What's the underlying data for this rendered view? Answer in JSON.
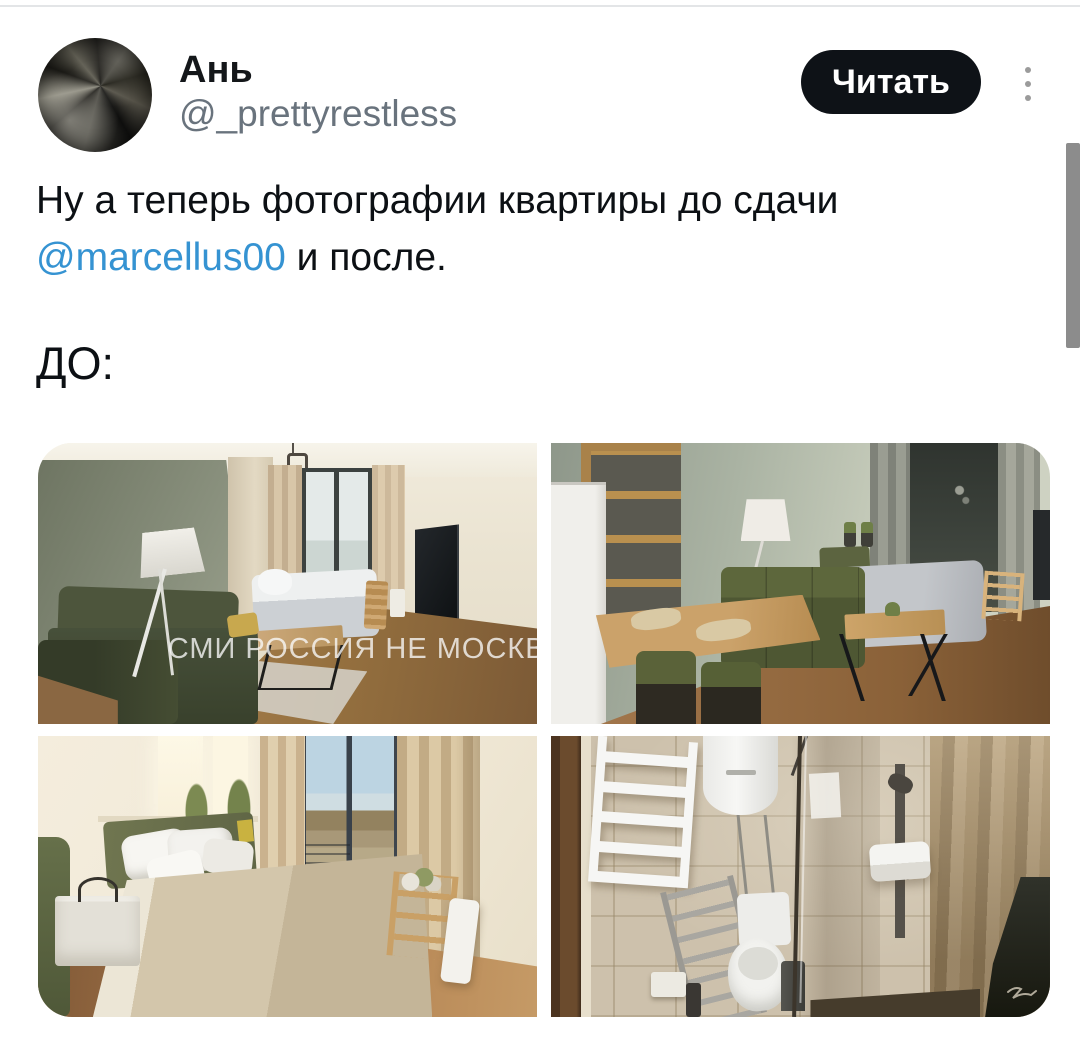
{
  "header": {
    "name": "Ань",
    "handle": "@_prettyrestless",
    "follow_label": "Читать"
  },
  "tweet": {
    "text_before": "Ну а теперь фотографии квартиры до сдачи ",
    "mention": "@marcellus00",
    "text_after": " и после.",
    "section_label": "ДО:"
  },
  "photos": {
    "watermark": "СМИ РОССИЯ НЕ МОСКВА",
    "items": [
      {
        "description": "Living room with green wall, olive sofa, floor lamp, coffee table, wall TV and bright window"
      },
      {
        "description": "Studio at evening with wooden bar table, green stools, green sofa, bed and curtained dark window"
      },
      {
        "description": "Bedroom with olive headboard, white pillows, beige bedspread and panoramic window with hill view"
      },
      {
        "description": "Bathroom with white towel radiator, water heater, toilet and glass shower with beige tiles"
      }
    ]
  },
  "colors": {
    "accent_blue": "#3593d2",
    "button_bg": "#0e1217",
    "text": "#0f1419",
    "handle_gray": "#69737d",
    "watermark_gray": "#eaeaea"
  }
}
